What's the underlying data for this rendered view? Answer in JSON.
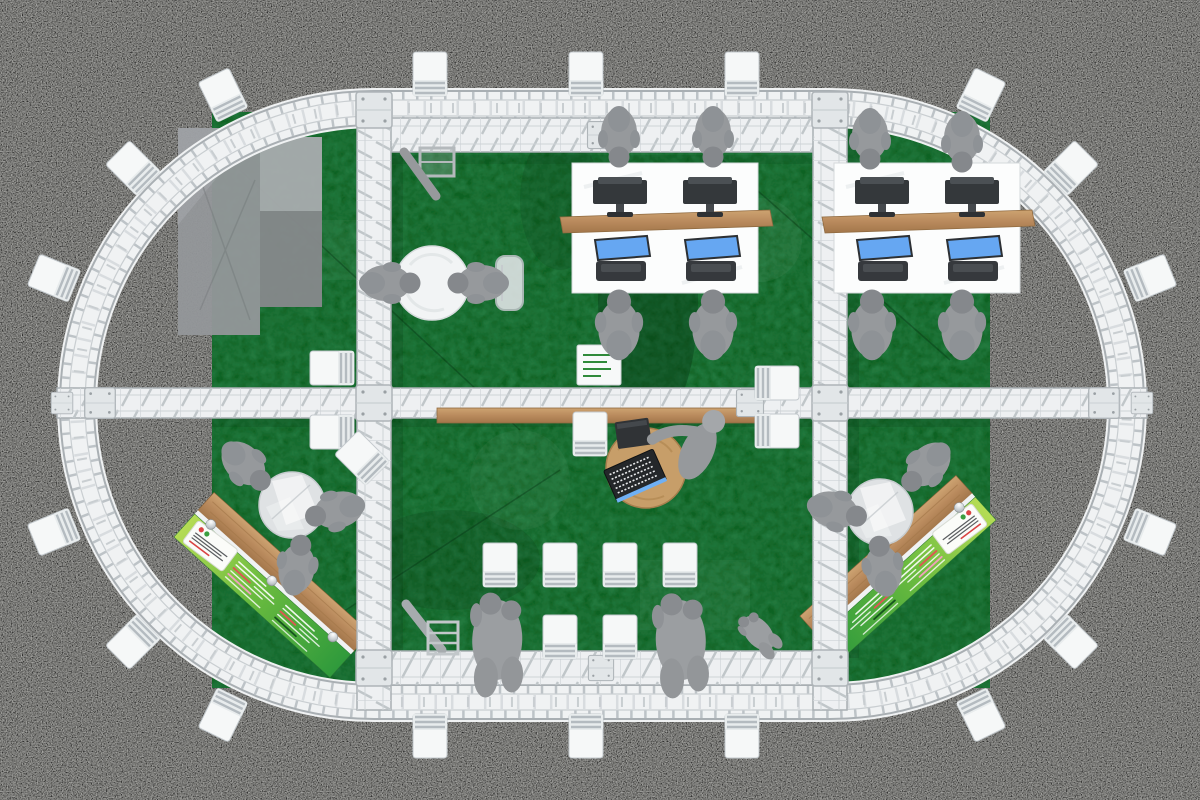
{
  "scene": {
    "description": "Top view 3D render of an oval truss exhibition booth on dark speckled carpet with green carpet floor, two dual-monitor workstation desks, four meeting tables, two green graphic reception counters, audience chair rows and white chairs placed around the outside of the truss ring",
    "floor_type": "green exhibition carpet",
    "surround_type": "dark speckled event carpet",
    "structure": "white aluminium truss ring (stadium shape) with internal truss grid"
  },
  "colors": {
    "carpet": "#2b2b29",
    "green_floor": "#0e6222",
    "truss": "#f0f2f3",
    "truss_rail": "#a9afb3",
    "wood": "#b98a5d",
    "people": "#96999c",
    "screen_blue": "#66a7f2",
    "monitor_dark": "#34383b",
    "counter_green_light": "#b5dc55",
    "counter_green_dark": "#2f9a3c",
    "chair": "#f6f8f8"
  },
  "inventory": {
    "perimeter_chairs": 18,
    "audience_chairs": 8,
    "loose_chairs": 6,
    "workstation_desks": 2,
    "monitors": 8,
    "meeting_tables": 4,
    "graphic_counters": 2,
    "people": 20
  },
  "counters": [
    {
      "t": "counter",
      "x": 272,
      "y": 585,
      "r": 42,
      "flip": false,
      "name": "graphic-counter-left"
    },
    {
      "t": "counter",
      "x": 898,
      "y": 568,
      "r": -42,
      "flip": true,
      "name": "graphic-counter-right"
    }
  ],
  "desks": [
    {
      "t": "workdesk",
      "x": 572,
      "y": 163,
      "name": "workstation-desk-left"
    },
    {
      "t": "workdesk",
      "x": 834,
      "y": 163,
      "name": "workstation-desk-right"
    }
  ],
  "tables": [
    {
      "t": "whiteTable",
      "x": 432,
      "y": 283,
      "name": "round-meeting-table-left"
    },
    {
      "t": "centerTable",
      "x": 646,
      "y": 468,
      "name": "round-laptop-table-center"
    },
    {
      "t": "glassTable",
      "x": 292,
      "y": 505,
      "name": "round-glass-table-bottom-left"
    },
    {
      "t": "glassTable",
      "x": 880,
      "y": 512,
      "name": "round-glass-table-bottom-right"
    }
  ],
  "misc": [
    {
      "t": "signBoard",
      "x": 577,
      "y": 345,
      "name": "white-sign-board"
    },
    {
      "t": "ladder",
      "x": 430,
      "y": 628,
      "name": "step-ladder"
    },
    {
      "t": "tvarm",
      "x": 420,
      "y": 168,
      "name": "mounted-display-arm"
    }
  ],
  "chairs": [
    {
      "x": 430,
      "y": 74,
      "r": 0,
      "name": "perimeter-chair"
    },
    {
      "x": 586,
      "y": 74,
      "r": 0,
      "name": "perimeter-chair"
    },
    {
      "x": 742,
      "y": 74,
      "r": 0,
      "name": "perimeter-chair"
    },
    {
      "x": 223,
      "y": 95,
      "r": -26,
      "name": "perimeter-chair"
    },
    {
      "x": 133,
      "y": 168,
      "r": -45,
      "name": "perimeter-chair"
    },
    {
      "x": 54,
      "y": 278,
      "r": -68,
      "name": "perimeter-chair"
    },
    {
      "x": 54,
      "y": 532,
      "r": -112,
      "name": "perimeter-chair"
    },
    {
      "x": 133,
      "y": 642,
      "r": -135,
      "name": "perimeter-chair"
    },
    {
      "x": 223,
      "y": 715,
      "r": -154,
      "name": "perimeter-chair"
    },
    {
      "x": 981,
      "y": 95,
      "r": 26,
      "name": "perimeter-chair"
    },
    {
      "x": 1071,
      "y": 168,
      "r": 45,
      "name": "perimeter-chair"
    },
    {
      "x": 1150,
      "y": 278,
      "r": 68,
      "name": "perimeter-chair"
    },
    {
      "x": 1150,
      "y": 532,
      "r": 112,
      "name": "perimeter-chair"
    },
    {
      "x": 1071,
      "y": 642,
      "r": 135,
      "name": "perimeter-chair"
    },
    {
      "x": 981,
      "y": 715,
      "r": 154,
      "name": "perimeter-chair"
    },
    {
      "x": 430,
      "y": 736,
      "r": 180,
      "name": "perimeter-chair"
    },
    {
      "x": 586,
      "y": 736,
      "r": 180,
      "name": "perimeter-chair"
    },
    {
      "x": 742,
      "y": 736,
      "r": 180,
      "name": "perimeter-chair"
    },
    {
      "x": 500,
      "y": 565,
      "r": 0,
      "name": "audience-chair"
    },
    {
      "x": 560,
      "y": 565,
      "r": 0,
      "name": "audience-chair"
    },
    {
      "x": 620,
      "y": 565,
      "r": 0,
      "name": "audience-chair"
    },
    {
      "x": 680,
      "y": 565,
      "r": 0,
      "name": "audience-chair"
    },
    {
      "x": 500,
      "y": 637,
      "r": 0,
      "name": "audience-chair"
    },
    {
      "x": 560,
      "y": 637,
      "r": 0,
      "name": "audience-chair"
    },
    {
      "x": 620,
      "y": 637,
      "r": 0,
      "name": "audience-chair"
    },
    {
      "x": 680,
      "y": 637,
      "r": 0,
      "name": "audience-chair"
    },
    {
      "x": 332,
      "y": 368,
      "r": -90,
      "name": "loose-chair"
    },
    {
      "x": 332,
      "y": 432,
      "r": -90,
      "name": "loose-chair"
    },
    {
      "x": 362,
      "y": 458,
      "r": -45,
      "name": "loose-chair"
    },
    {
      "x": 590,
      "y": 434,
      "r": 0,
      "name": "loose-chair"
    },
    {
      "x": 777,
      "y": 383,
      "r": 90,
      "name": "loose-chair"
    },
    {
      "x": 777,
      "y": 431,
      "r": 90,
      "name": "loose-chair"
    }
  ],
  "people": [
    {
      "t": "personSeated",
      "x": 619,
      "y": 141,
      "r": 180,
      "name": "person-at-desk"
    },
    {
      "t": "personSeated",
      "x": 713,
      "y": 141,
      "r": 180,
      "name": "person-at-desk"
    },
    {
      "t": "personSeated",
      "x": 619,
      "y": 320,
      "r": 0,
      "s": 1.15,
      "name": "person-at-desk"
    },
    {
      "t": "personSeated",
      "x": 713,
      "y": 320,
      "r": 0,
      "s": 1.15,
      "name": "person-at-desk"
    },
    {
      "t": "personSeated",
      "x": 870,
      "y": 143,
      "r": 180,
      "name": "person-at-desk"
    },
    {
      "t": "personSeated",
      "x": 962,
      "y": 146,
      "r": 180,
      "name": "person-at-desk"
    },
    {
      "t": "personSeated",
      "x": 872,
      "y": 320,
      "r": 0,
      "s": 1.15,
      "name": "person-at-desk"
    },
    {
      "t": "personSeated",
      "x": 962,
      "y": 320,
      "r": 0,
      "s": 1.15,
      "name": "person-at-desk"
    },
    {
      "t": "personSeated",
      "x": 394,
      "y": 283,
      "r": 90,
      "name": "person-at-table"
    },
    {
      "t": "personSeated",
      "x": 474,
      "y": 283,
      "r": -90,
      "name": "person-at-table"
    },
    {
      "t": "personSeated",
      "x": 249,
      "y": 469,
      "r": 135,
      "name": "person-at-table"
    },
    {
      "t": "personSeated",
      "x": 331,
      "y": 512,
      "r": -105,
      "name": "person-at-table"
    },
    {
      "t": "personSeated",
      "x": 298,
      "y": 561,
      "r": 10,
      "name": "person-at-table"
    },
    {
      "t": "personSeated",
      "x": 923,
      "y": 470,
      "r": -135,
      "name": "person-at-table"
    },
    {
      "t": "personSeated",
      "x": 841,
      "y": 512,
      "r": 105,
      "name": "person-at-table"
    },
    {
      "t": "personSeated",
      "x": 882,
      "y": 562,
      "r": -10,
      "name": "person-at-table"
    },
    {
      "t": "personLean",
      "x": 700,
      "y": 446,
      "r": 25,
      "name": "person-at-laptop"
    },
    {
      "t": "personPair",
      "x": 500,
      "y": 618,
      "r": 2,
      "name": "people-standing"
    },
    {
      "t": "personPair",
      "x": 682,
      "y": 618,
      "r": -2,
      "name": "people-standing"
    },
    {
      "t": "personPair",
      "x": 752,
      "y": 624,
      "r": -40,
      "s": 0.5,
      "name": "people-standing"
    }
  ]
}
